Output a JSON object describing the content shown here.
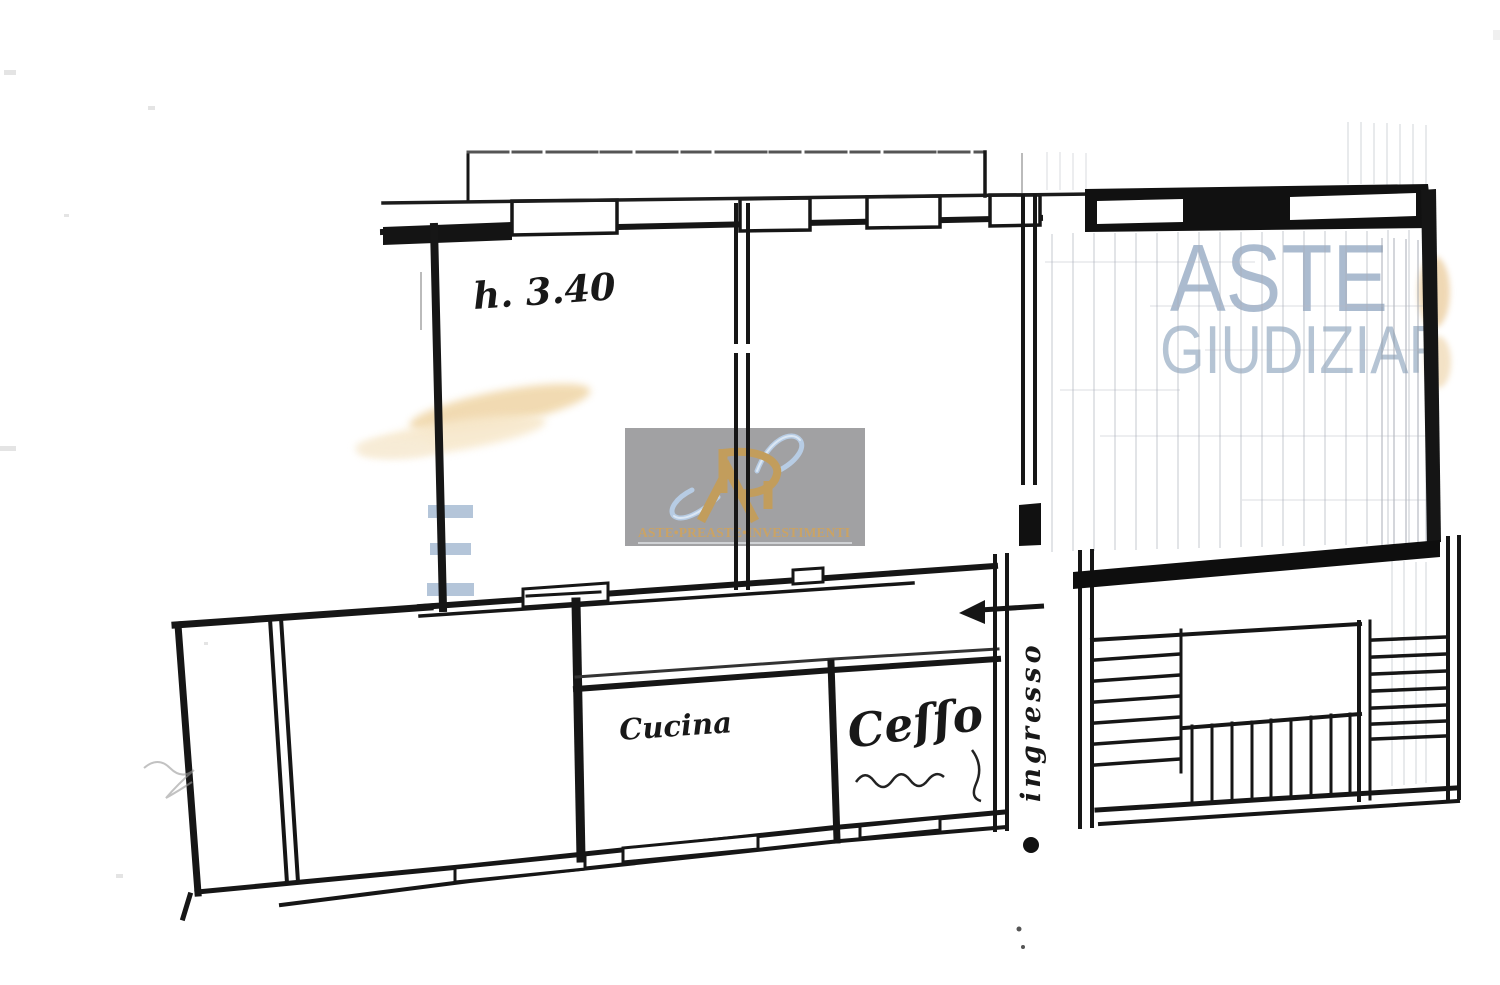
{
  "watermark": {
    "line1": "ASTE",
    "line2": "GIUDIZIAR",
    "color_line1": "#9db0c7",
    "color_line2": "#a9bacd",
    "partial_letter": "E",
    "partial_letter_color": "#9fb6cf"
  },
  "logo": {
    "monogram": "Ri",
    "brand": "ASTE•PREASTE•INVESTIMENTI",
    "panel_color": "#9a9a9c",
    "gold": "#c29d5c",
    "swoosh_blue": "#b7cce4"
  },
  "labels": {
    "height": "h. 3.40",
    "kitchen": "Cucina",
    "toilet": "Ceſſo",
    "entrance": "ingresso"
  },
  "colors": {
    "ink": "#161616",
    "pencil_grid": "#a9aeb8",
    "stain_beige": "#f1d9ae"
  }
}
